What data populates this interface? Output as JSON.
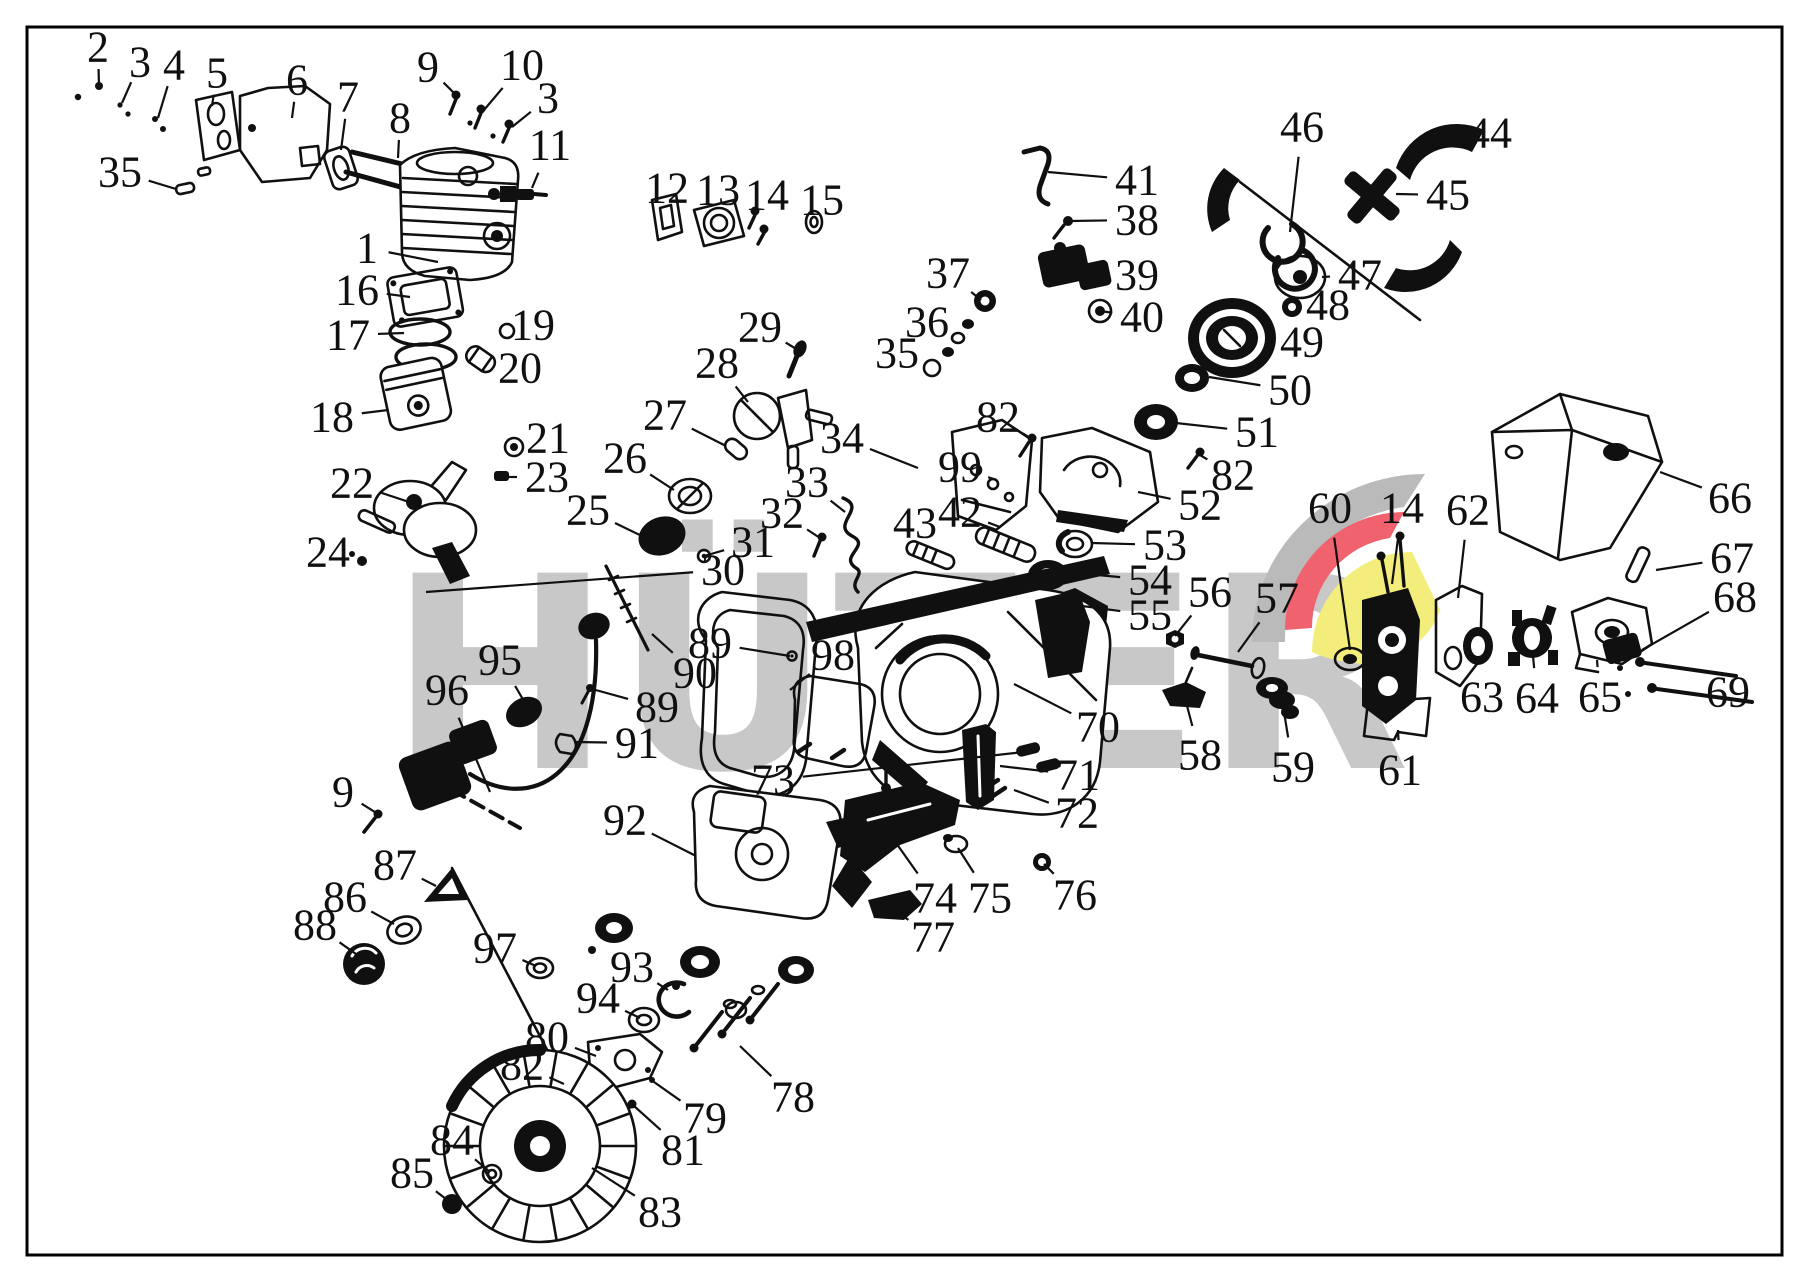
{
  "image": {
    "width": 1809,
    "height": 1283,
    "background": "#ffffff",
    "border_color": "#000000"
  },
  "watermark": {
    "text": "HÜTER",
    "text_color": "#c8c8c8",
    "logo": {
      "gray": "#bababa",
      "red": "#f0626e",
      "yellow": "#f3ee7c"
    }
  },
  "diagram": {
    "type": "exploded-parts-diagram",
    "line_color": "#101010",
    "callouts": [
      {
        "label": "2",
        "x": 98,
        "y": 47,
        "tx": 99,
        "ty": 86
      },
      {
        "label": "3",
        "x": 140,
        "y": 62,
        "tx": 122,
        "ty": 103
      },
      {
        "label": "4",
        "x": 174,
        "y": 65,
        "tx": 158,
        "ty": 118
      },
      {
        "label": "5",
        "x": 217,
        "y": 73,
        "tx": 212,
        "ty": 106
      },
      {
        "label": "6",
        "x": 297,
        "y": 80,
        "tx": 292,
        "ty": 118
      },
      {
        "label": "7",
        "x": 348,
        "y": 97,
        "tx": 341,
        "ty": 150
      },
      {
        "label": "8",
        "x": 400,
        "y": 118,
        "tx": 398,
        "ty": 158
      },
      {
        "label": "9",
        "x": 428,
        "y": 67,
        "tx": 456,
        "ty": 95
      },
      {
        "label": "10",
        "x": 522,
        "y": 65,
        "tx": 484,
        "ty": 110
      },
      {
        "label": "3",
        "x": 548,
        "y": 98,
        "tx": 512,
        "ty": 127
      },
      {
        "label": "11",
        "x": 550,
        "y": 145,
        "tx": 532,
        "ty": 188
      },
      {
        "label": "35",
        "x": 120,
        "y": 172,
        "tx": 176,
        "ty": 189
      },
      {
        "label": "1",
        "x": 367,
        "y": 248,
        "tx": 438,
        "ty": 262
      },
      {
        "label": "12",
        "x": 667,
        "y": 188,
        "tx": 663,
        "ty": 214
      },
      {
        "label": "13",
        "x": 718,
        "y": 190,
        "tx": 714,
        "ty": 216
      },
      {
        "label": "14",
        "x": 767,
        "y": 195,
        "tx": 757,
        "ty": 212
      },
      {
        "label": "15",
        "x": 822,
        "y": 200,
        "tx": 813,
        "ty": 219
      },
      {
        "label": "16",
        "x": 357,
        "y": 290,
        "tx": 410,
        "ty": 297
      },
      {
        "label": "17",
        "x": 348,
        "y": 335,
        "tx": 404,
        "ty": 333
      },
      {
        "label": "19",
        "x": 533,
        "y": 325,
        "tx": 507,
        "ty": 331
      },
      {
        "label": "20",
        "x": 520,
        "y": 368,
        "tx": 488,
        "ty": 362
      },
      {
        "label": "18",
        "x": 332,
        "y": 417,
        "tx": 388,
        "ty": 410
      },
      {
        "label": "21",
        "x": 548,
        "y": 438,
        "tx": 517,
        "ty": 446
      },
      {
        "label": "23",
        "x": 547,
        "y": 477,
        "tx": 505,
        "ty": 477
      },
      {
        "label": "22",
        "x": 352,
        "y": 483,
        "tx": 412,
        "ty": 503
      },
      {
        "label": "24",
        "x": 328,
        "y": 552,
        "tx": 360,
        "ty": 561
      },
      {
        "label": "25",
        "x": 588,
        "y": 510,
        "tx": 646,
        "ty": 538
      },
      {
        "label": "26",
        "x": 625,
        "y": 458,
        "tx": 674,
        "ty": 490
      },
      {
        "label": "27",
        "x": 665,
        "y": 415,
        "tx": 726,
        "ty": 446
      },
      {
        "label": "28",
        "x": 717,
        "y": 363,
        "tx": 748,
        "ty": 402
      },
      {
        "label": "29",
        "x": 760,
        "y": 327,
        "tx": 798,
        "ty": 350
      },
      {
        "label": "34",
        "x": 842,
        "y": 438,
        "tx": 918,
        "ty": 468
      },
      {
        "label": "33",
        "x": 807,
        "y": 482,
        "tx": 845,
        "ty": 512
      },
      {
        "label": "32",
        "x": 782,
        "y": 513,
        "tx": 820,
        "ty": 538
      },
      {
        "label": "31",
        "x": 753,
        "y": 542,
        "tx": 704,
        "ty": 556
      },
      {
        "label": "30",
        "x": 723,
        "y": 570,
        "tx": 426,
        "ty": 592
      },
      {
        "label": "37",
        "x": 948,
        "y": 273,
        "tx": 981,
        "ty": 300
      },
      {
        "label": "36",
        "x": 927,
        "y": 322,
        "tx": 954,
        "ty": 340
      },
      {
        "label": "35",
        "x": 897,
        "y": 353,
        "tx": 926,
        "ty": 366
      },
      {
        "label": "41",
        "x": 1137,
        "y": 180,
        "tx": 1048,
        "ty": 172
      },
      {
        "label": "38",
        "x": 1137,
        "y": 220,
        "tx": 1070,
        "ty": 221
      },
      {
        "label": "39",
        "x": 1137,
        "y": 275,
        "tx": 1092,
        "ty": 268
      },
      {
        "label": "40",
        "x": 1142,
        "y": 317,
        "tx": 1100,
        "ty": 311
      },
      {
        "label": "46",
        "x": 1302,
        "y": 127,
        "tx": 1290,
        "ty": 232
      },
      {
        "label": "44",
        "x": 1490,
        "y": 133,
        "tx": 1436,
        "ty": 146
      },
      {
        "label": "45",
        "x": 1448,
        "y": 195,
        "tx": 1396,
        "ty": 194
      },
      {
        "label": "47",
        "x": 1360,
        "y": 275,
        "tx": 1322,
        "ty": 277
      },
      {
        "label": "48",
        "x": 1328,
        "y": 305,
        "tx": 1300,
        "ty": 306
      },
      {
        "label": "49",
        "x": 1302,
        "y": 342,
        "tx": 1270,
        "ty": 337
      },
      {
        "label": "50",
        "x": 1290,
        "y": 390,
        "tx": 1209,
        "ty": 377
      },
      {
        "label": "51",
        "x": 1257,
        "y": 432,
        "tx": 1176,
        "ty": 423
      },
      {
        "label": "82",
        "x": 998,
        "y": 417,
        "tx": 1030,
        "ty": 438
      },
      {
        "label": "82",
        "x": 1233,
        "y": 475,
        "tx": 1200,
        "ty": 455
      },
      {
        "label": "99",
        "x": 960,
        "y": 467,
        "tx": 996,
        "ty": 480
      },
      {
        "label": "42",
        "x": 960,
        "y": 512,
        "tx": 1000,
        "ty": 527
      },
      {
        "label": "43",
        "x": 915,
        "y": 523,
        "tx": 944,
        "ty": 540
      },
      {
        "label": "52",
        "x": 1200,
        "y": 505,
        "tx": 1138,
        "ty": 492
      },
      {
        "label": "53",
        "x": 1165,
        "y": 545,
        "tx": 1092,
        "ty": 543
      },
      {
        "label": "54",
        "x": 1150,
        "y": 580,
        "tx": 1066,
        "ty": 572
      },
      {
        "label": "55",
        "x": 1150,
        "y": 615,
        "tx": 1052,
        "ty": 602
      },
      {
        "label": "56",
        "x": 1210,
        "y": 592,
        "tx": 1175,
        "ty": 636
      },
      {
        "label": "57",
        "x": 1277,
        "y": 598,
        "tx": 1238,
        "ty": 652
      },
      {
        "label": "60",
        "x": 1330,
        "y": 508,
        "tx": 1350,
        "ty": 650
      },
      {
        "label": "14",
        "x": 1402,
        "y": 508,
        "tx": 1392,
        "ty": 584
      },
      {
        "label": "62",
        "x": 1468,
        "y": 510,
        "tx": 1458,
        "ty": 598
      },
      {
        "label": "66",
        "x": 1730,
        "y": 498,
        "tx": 1660,
        "ty": 472
      },
      {
        "label": "67",
        "x": 1732,
        "y": 558,
        "tx": 1656,
        "ty": 570
      },
      {
        "label": "68",
        "x": 1735,
        "y": 597,
        "tx": 1642,
        "ty": 650
      },
      {
        "label": "69",
        "x": 1728,
        "y": 692,
        "tx": 1716,
        "ty": 672
      },
      {
        "label": "63",
        "x": 1482,
        "y": 697,
        "tx": 1478,
        "ty": 662
      },
      {
        "label": "64",
        "x": 1537,
        "y": 698,
        "tx": 1533,
        "ty": 656
      },
      {
        "label": "65",
        "x": 1600,
        "y": 697,
        "tx": 1597,
        "ty": 660
      },
      {
        "label": "61",
        "x": 1400,
        "y": 770,
        "tx": 1398,
        "ty": 730
      },
      {
        "label": "58",
        "x": 1200,
        "y": 755,
        "tx": 1186,
        "ty": 702
      },
      {
        "label": "59",
        "x": 1293,
        "y": 767,
        "tx": 1284,
        "ty": 712
      },
      {
        "label": "70",
        "x": 1098,
        "y": 727,
        "tx": 1014,
        "ty": 684
      },
      {
        "label": "71",
        "x": 1078,
        "y": 775,
        "tx": 1000,
        "ty": 766
      },
      {
        "label": "72",
        "x": 1077,
        "y": 813,
        "tx": 1014,
        "ty": 790
      },
      {
        "label": "73",
        "x": 773,
        "y": 780,
        "tx": 1024,
        "ty": 752
      },
      {
        "label": "89",
        "x": 710,
        "y": 643,
        "tx": 790,
        "ty": 656
      },
      {
        "label": "90",
        "x": 695,
        "y": 673,
        "tx": 652,
        "ty": 634
      },
      {
        "label": "89",
        "x": 657,
        "y": 707,
        "tx": 592,
        "ty": 689
      },
      {
        "label": "91",
        "x": 637,
        "y": 743,
        "tx": 574,
        "ty": 742
      },
      {
        "label": "98",
        "x": 833,
        "y": 655,
        "tx": 790,
        "ty": 690
      },
      {
        "label": "95",
        "x": 500,
        "y": 660,
        "tx": 528,
        "ty": 708
      },
      {
        "label": "96",
        "x": 447,
        "y": 690,
        "tx": 490,
        "ty": 792
      },
      {
        "label": "9",
        "x": 343,
        "y": 792,
        "tx": 378,
        "ty": 814
      },
      {
        "label": "87",
        "x": 395,
        "y": 865,
        "tx": 436,
        "ty": 886
      },
      {
        "label": "86",
        "x": 345,
        "y": 897,
        "tx": 394,
        "ty": 924
      },
      {
        "label": "88",
        "x": 315,
        "y": 925,
        "tx": 356,
        "ty": 954
      },
      {
        "label": "92",
        "x": 625,
        "y": 820,
        "tx": 696,
        "ty": 856
      },
      {
        "label": "74",
        "x": 935,
        "y": 898,
        "tx": 894,
        "ty": 840
      },
      {
        "label": "75",
        "x": 990,
        "y": 898,
        "tx": 958,
        "ty": 848
      },
      {
        "label": "76",
        "x": 1075,
        "y": 895,
        "tx": 1044,
        "ty": 864
      },
      {
        "label": "77",
        "x": 933,
        "y": 937,
        "tx": 900,
        "ty": 914
      },
      {
        "label": "97",
        "x": 495,
        "y": 948,
        "tx": 536,
        "ty": 966
      },
      {
        "label": "93",
        "x": 632,
        "y": 967,
        "tx": 668,
        "ty": 990
      },
      {
        "label": "94",
        "x": 598,
        "y": 998,
        "tx": 640,
        "ty": 1018
      },
      {
        "label": "80",
        "x": 547,
        "y": 1037,
        "tx": 596,
        "ty": 1056
      },
      {
        "label": "82",
        "x": 522,
        "y": 1065,
        "tx": 564,
        "ty": 1084
      },
      {
        "label": "78",
        "x": 793,
        "y": 1097,
        "tx": 740,
        "ty": 1046
      },
      {
        "label": "79",
        "x": 705,
        "y": 1118,
        "tx": 654,
        "ty": 1082
      },
      {
        "label": "81",
        "x": 683,
        "y": 1150,
        "tx": 634,
        "ty": 1106
      },
      {
        "label": "84",
        "x": 452,
        "y": 1140,
        "tx": 490,
        "ty": 1172
      },
      {
        "label": "85",
        "x": 412,
        "y": 1173,
        "tx": 450,
        "ty": 1202
      },
      {
        "label": "83",
        "x": 660,
        "y": 1212,
        "tx": 592,
        "ty": 1168
      }
    ]
  }
}
